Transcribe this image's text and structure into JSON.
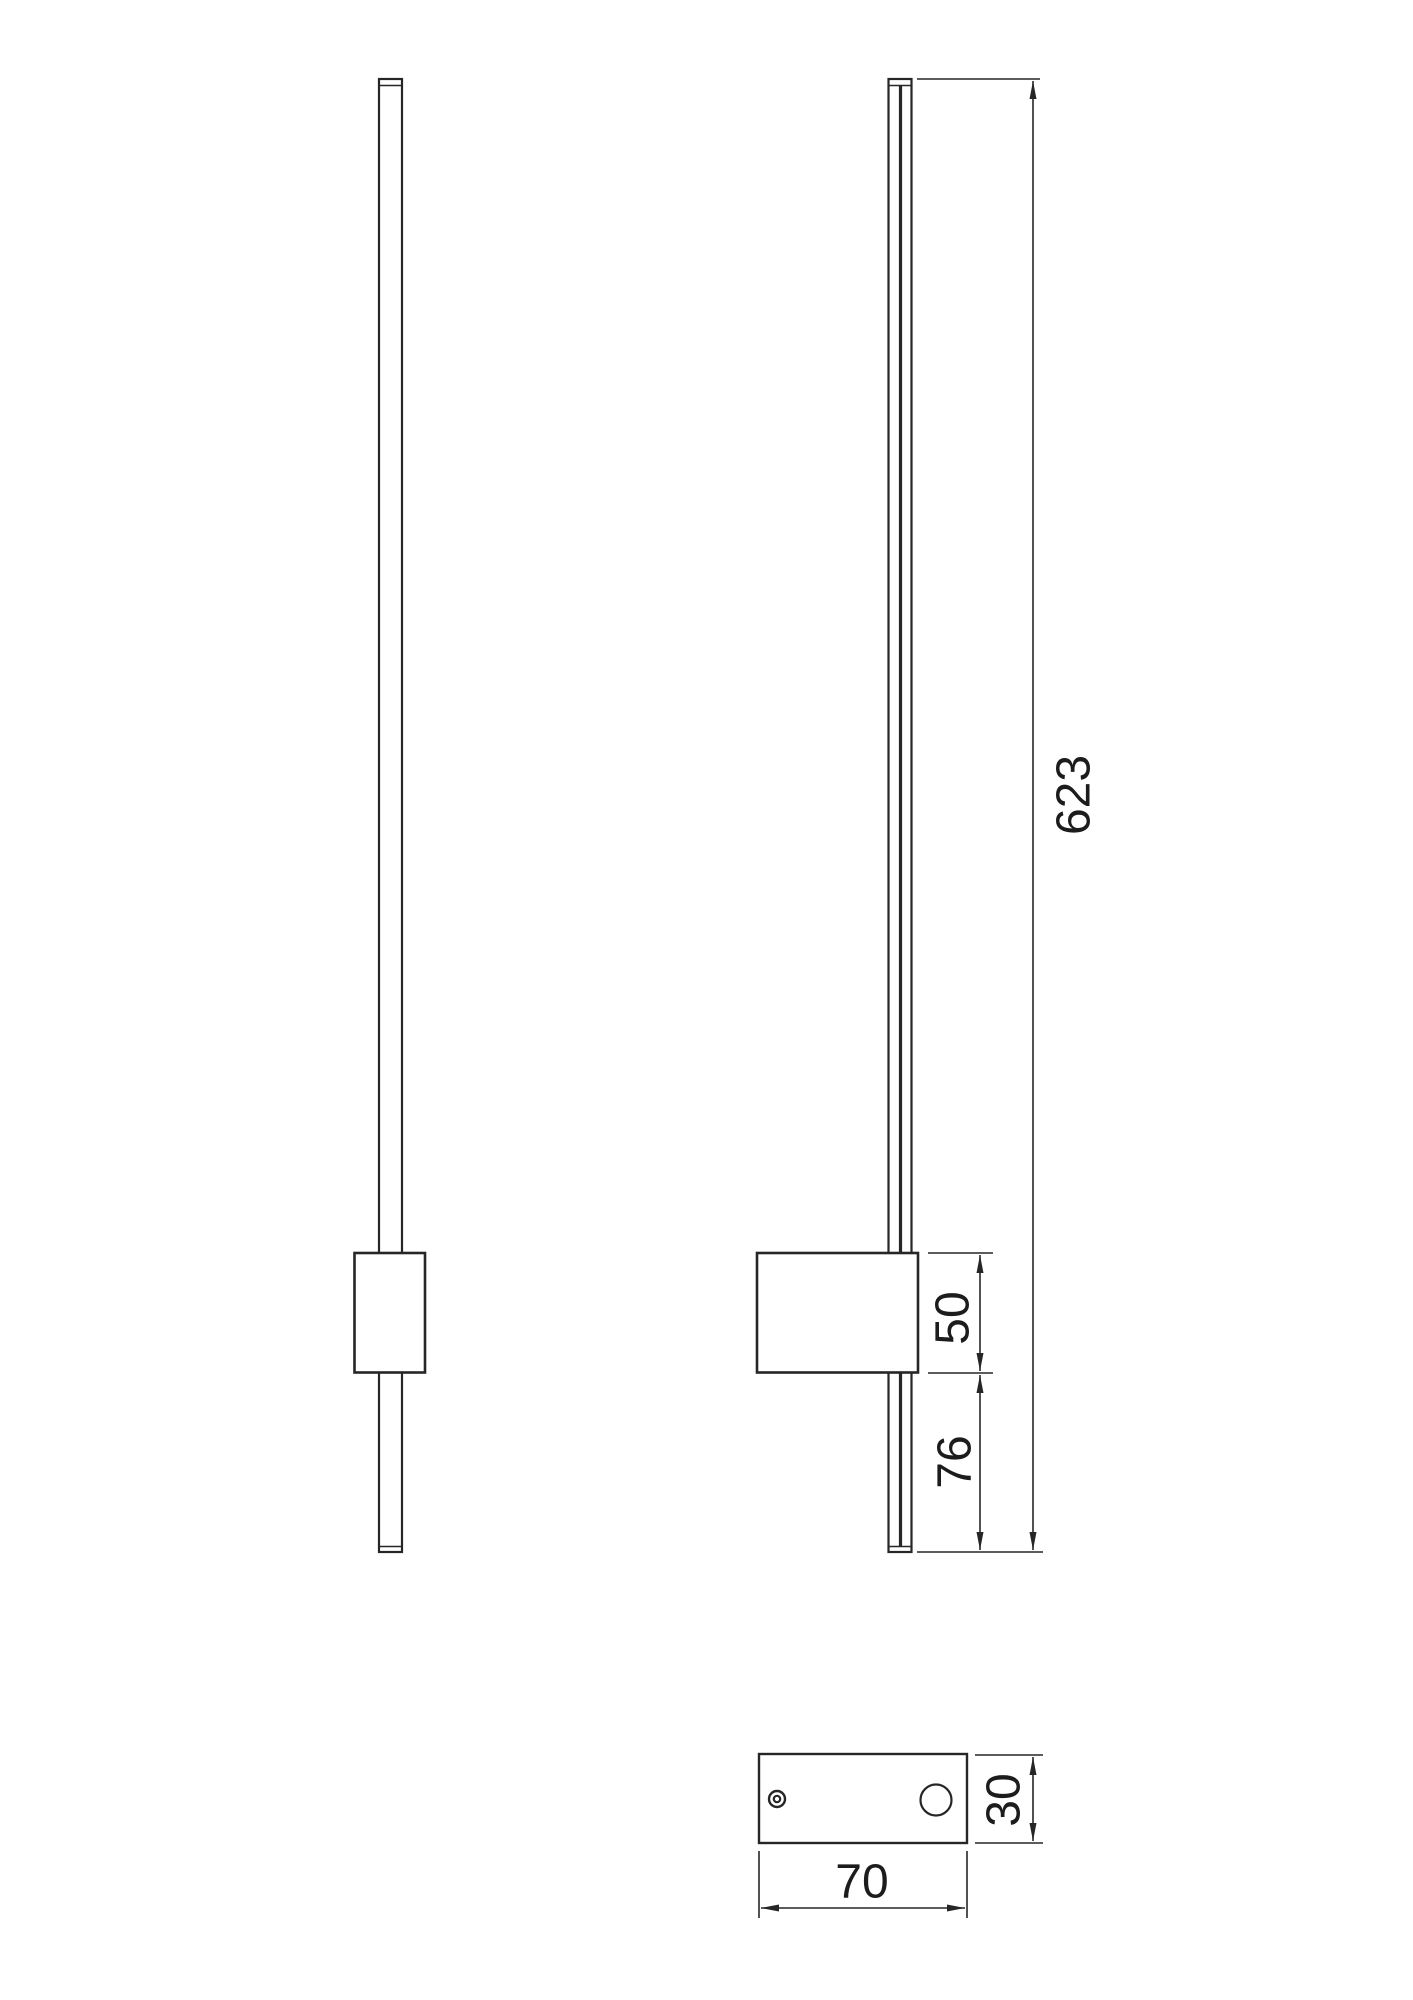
{
  "drawing": {
    "type": "wall-lamp-technical-drawing",
    "dimensions": {
      "overall_height": "623",
      "driver_box_height": "50",
      "lower_section_length": "76",
      "plate_depth": "30",
      "plate_width": "70"
    },
    "colors": {
      "line": "#262626",
      "background": "#ffffff"
    }
  }
}
